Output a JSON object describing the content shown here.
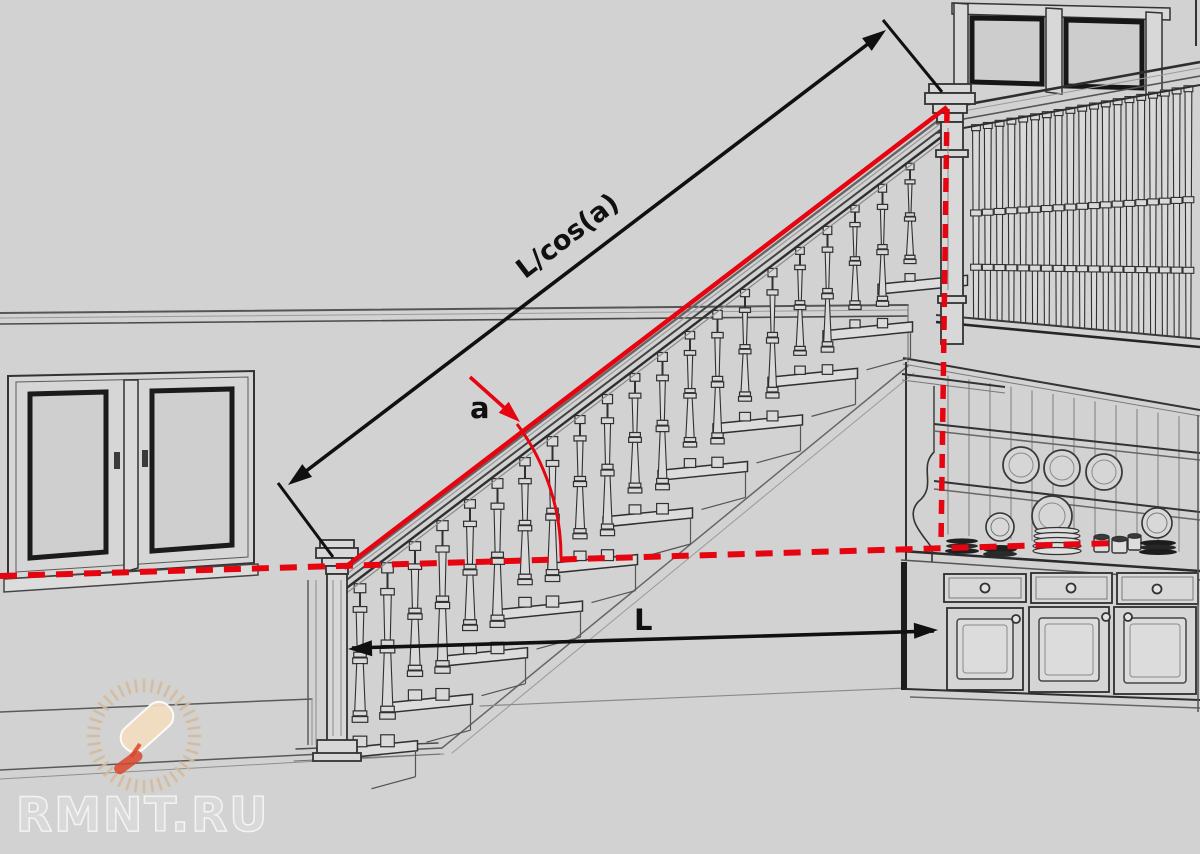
{
  "page": {
    "title": "Staircase length calculation diagram"
  },
  "diagram": {
    "labels": {
      "hypotenuse": "L/cos(a)",
      "angle": "a",
      "run": "L"
    }
  },
  "watermark": {
    "text": "RMNT.RU",
    "logo": "paint-roller-sunburst"
  },
  "colors": {
    "background": "#d2d2d2",
    "ink": "#303030",
    "ink_light": "#8c8c8c",
    "fill_light": "#d9d9d9",
    "annotation_red": "#e60410",
    "dimension_black": "#101010",
    "watermark_white": "#ffffff",
    "watermark_tan": "#e3c49c",
    "watermark_red": "#d9472e"
  }
}
